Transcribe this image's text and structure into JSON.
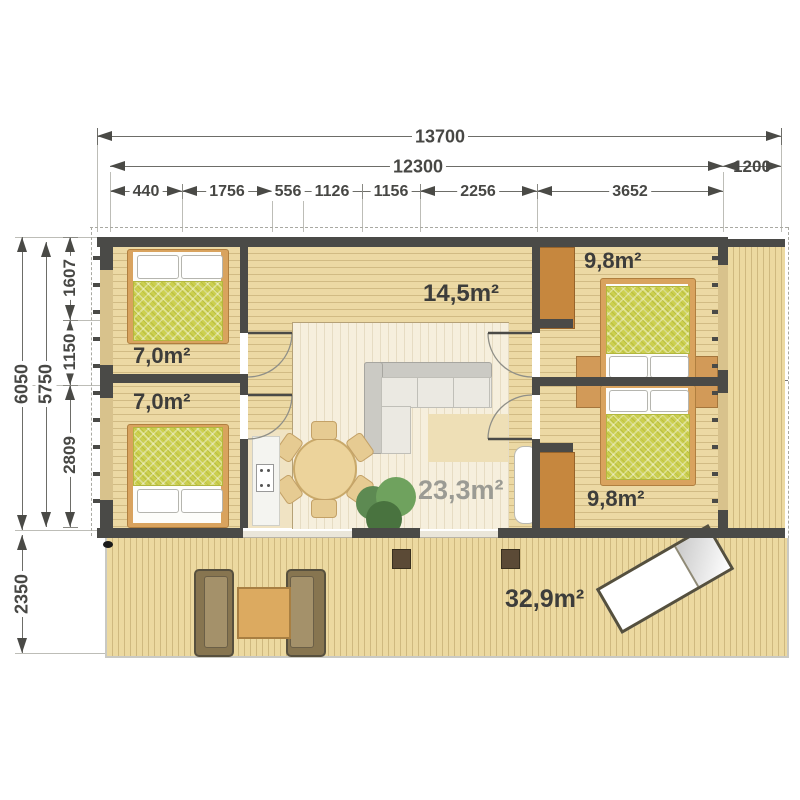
{
  "drawing": {
    "type": "floor-plan",
    "unit_note": "dimensions in millimetres, areas in m²"
  },
  "dimensions": {
    "top_total": "13700",
    "top_main": "12300",
    "top_side": "1200",
    "top_segments": [
      "440",
      "1756",
      "556",
      "1126",
      "1156",
      "2256",
      "3652"
    ],
    "left_total": "6050",
    "left_inner": "5750",
    "left_segments": [
      "1607",
      "1150",
      "2809"
    ],
    "terrace_depth": "2350"
  },
  "rooms": {
    "bedroom_left_top": "7,0m²",
    "bedroom_left_bottom": "7,0m²",
    "hallway": "14,5m²",
    "bedroom_right_top": "9,8m²",
    "bedroom_right_bottom": "9,8m²",
    "living_room": "23,3m²",
    "terrace": "32,9m²"
  },
  "colors": {
    "wall": "#4a4a47",
    "floor": "#ecd9a4",
    "living_floor": "#f6efdd",
    "deck": "#ecd9a0",
    "bed_duvet": "#ccd04f",
    "bed_frame": "#d9a35e",
    "wardrobe": "#c6873e",
    "label_dark": "#3d3d3b",
    "label_muted": "#9b9b94",
    "dimension_text": "#474744"
  }
}
